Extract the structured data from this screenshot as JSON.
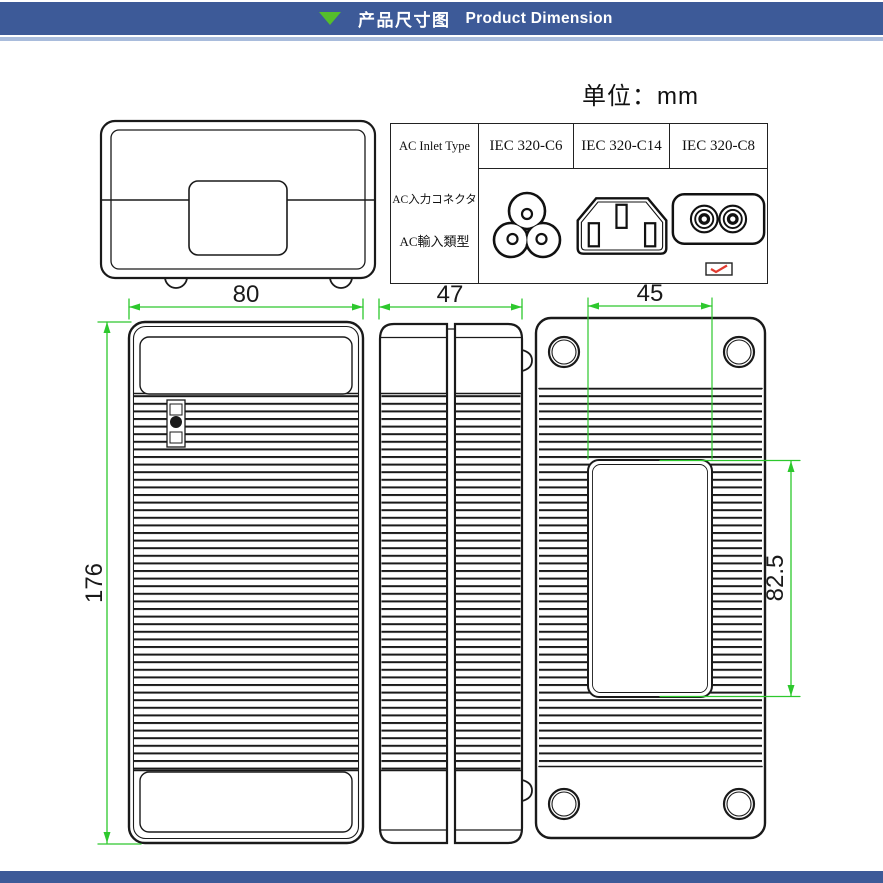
{
  "header": {
    "title_zh": "产品尺寸图",
    "title_en": "Product Dimension",
    "bar_color": "#3D5A98",
    "underline_color": "#A9BCDC",
    "triangle_icon_color": "#55BE2B"
  },
  "footer": {
    "bar_color": "#3D5A98"
  },
  "unit_note": "单位：mm",
  "inlet_table": {
    "row_header": {
      "line1": "AC Inlet Type",
      "line2": "AC入力コネクタ",
      "line3": "AC輸入類型"
    },
    "columns": [
      {
        "label": "IEC 320-C6",
        "icon": "iec-320-c6-connector-icon",
        "selected": false
      },
      {
        "label": "IEC 320-C14",
        "icon": "iec-320-c14-connector-icon",
        "selected": false
      },
      {
        "label": "IEC 320-C8",
        "icon": "iec-320-c8-connector-icon",
        "selected": true
      }
    ],
    "selected_mark_color": "#E23B30"
  },
  "drawing": {
    "outline_color": "#1A1A1A",
    "dimension_color": "#2DC82D",
    "dims": {
      "top_view_width": "80",
      "top_view_height": "176",
      "side_view_width": "47",
      "label_recess_width": "45",
      "label_recess_height": "82.5"
    }
  }
}
